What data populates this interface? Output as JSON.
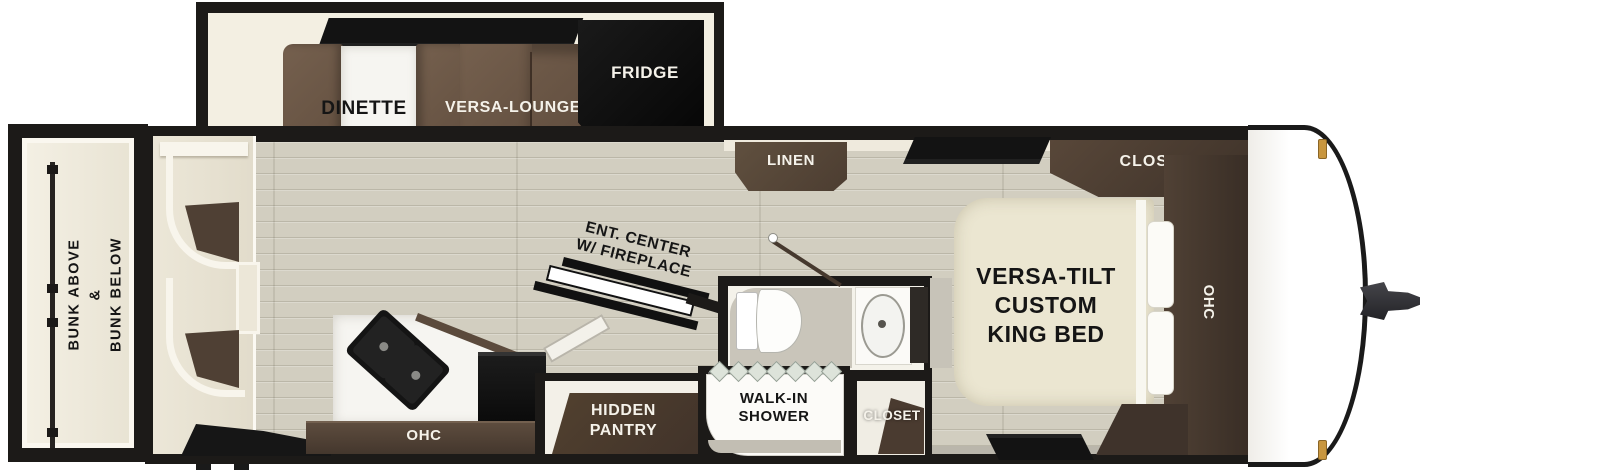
{
  "floorplan": {
    "rear_bunks": {
      "label": "BUNK ABOVE\n&\nBUNK BELOW"
    },
    "slideout": {
      "dinette": "DINETTE",
      "versa_lounge": "VERSA-LOUNGE",
      "fridge": "FRIDGE"
    },
    "living": {
      "linen": "LINEN",
      "ent_center": "ENT. CENTER\nW/ FIREPLACE",
      "kitchen_ohc": "OHC",
      "hidden_pantry": "HIDDEN\nPANTRY"
    },
    "bathroom": {
      "shower": "WALK-IN\nSHOWER",
      "closet": "CLOSET"
    },
    "bedroom": {
      "bed": "VERSA-TILT\nCUSTOM\nKING BED",
      "closet": "CLOSET",
      "ohc": "OHC"
    },
    "colors": {
      "wall": "#1c1a18",
      "floor_plank": "#d2cec0",
      "slide_floor": "#f3efe2",
      "sofa_brown": "#6f5847",
      "cabinet_brown": "#4a3b31",
      "bed_cream": "#ebe6d1",
      "marker_light_gold": "#c8963f"
    }
  }
}
